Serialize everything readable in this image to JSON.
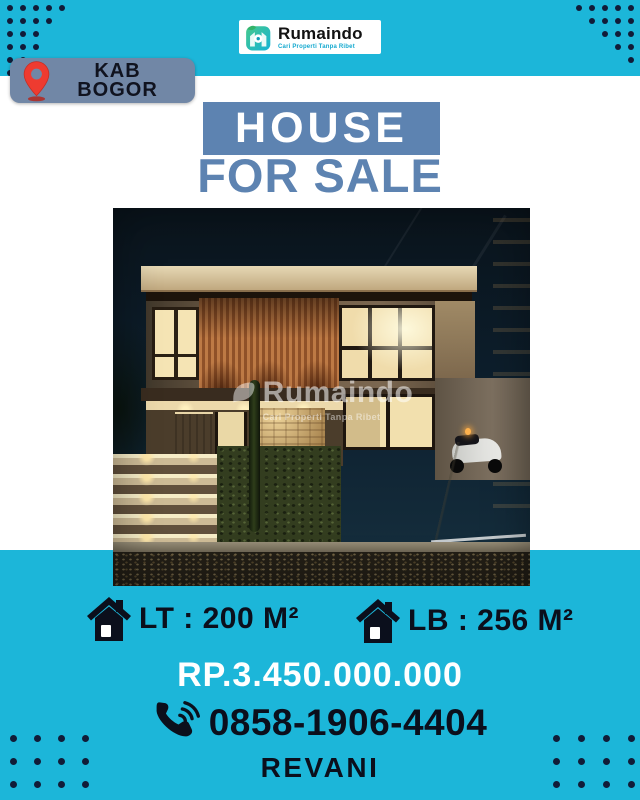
{
  "brand": {
    "name": "Rumaindo",
    "tagline": "Cari Properti Tanpa Ribet"
  },
  "location": {
    "line1": "KAB",
    "line2": "BOGOR"
  },
  "title": {
    "line1": "HOUSE",
    "line2": "FOR SALE"
  },
  "photo": {
    "watermark": "Rumaindo",
    "watermark_tagline": "Cari Properti Tanpa Ribet"
  },
  "specs": [
    {
      "icon": "house-icon",
      "label": "LT : 200 M²"
    },
    {
      "icon": "house-icon",
      "label": "LB : 256 M²"
    }
  ],
  "price": "RP.3.450.000.000",
  "contact": {
    "phone_icon": "phone-volume-icon",
    "phone": "0858-1906-4404",
    "agent": "REVANI"
  },
  "icons": {
    "location": "map-pin-icon",
    "brand": "rumaindo-house-leaf-icon"
  },
  "colors": {
    "teal": "#1cb6d9",
    "navy_dots": "#111c38",
    "steel_blue": "#5d83b1",
    "badge_blue": "#7187a6",
    "pin_red": "#ee3b30",
    "text_dark": "#0b0f1c",
    "price_text": "#ffffff"
  }
}
